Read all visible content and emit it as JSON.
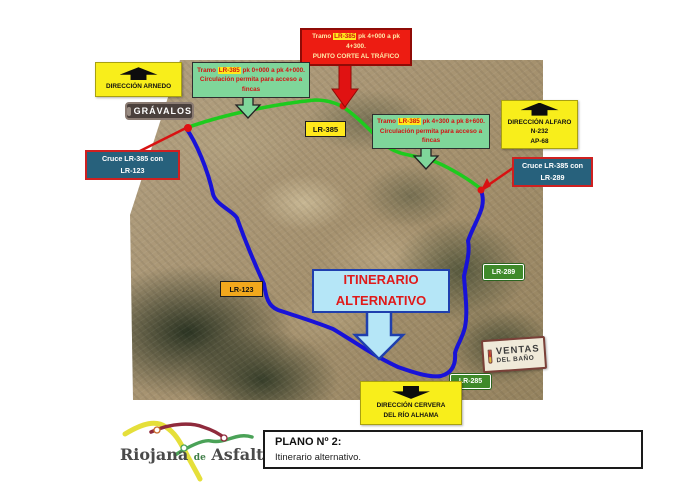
{
  "plan": {
    "cut_notice": {
      "pre": "Tramo ",
      "route": "LR-385",
      "post": " pk 4+000 a pk 4+300.",
      "line2": "PUNTO CORTE AL TRÁFICO"
    },
    "dir_arnedo": {
      "label": "DIRECCIÓN ARNEDO"
    },
    "tramo1": {
      "pre": "Tramo ",
      "route": "LR-385",
      "post": " pk 0+000 a pk 4+000. Circulación permita para acceso a fincas"
    },
    "tramo2": {
      "pre": "Tramo ",
      "route": "LR-385",
      "post": " pk 4+300 a pk 8+600. Circulación permita para acceso a fincas"
    },
    "gravalos": "GRÁVALOS",
    "lr385": "LR-385",
    "dir_alfaro": {
      "line1": "DIRECCIÓN ALFARO",
      "line2": "N-232",
      "line3": "AP-68"
    },
    "cruce_289": {
      "line1": "Cruce LR-385 con",
      "line2": "LR-289"
    },
    "cruce_123": {
      "line1": "Cruce LR-385 con",
      "line2": "LR-123"
    },
    "lr289": "LR-289",
    "lr123": "LR-123",
    "itinerario": {
      "line1": "ITINERARIO",
      "line2": "ALTERNATIVO"
    },
    "ventas": {
      "line1": "VENTAS",
      "line2": "DEL BAÑO"
    },
    "lr285": "LR-285",
    "dir_cervera": {
      "line1": "DIRECCIÓN CERVERA",
      "line2": "DEL RÍO ALHAMA"
    }
  },
  "colors": {
    "route_open_green": "#1ecb1e",
    "route_alternative_blue": "#1812d8",
    "alert_red": "#ed1c12",
    "direction_sign_yellow": "#f8ee1b",
    "info_box_green": "#7fd69a",
    "cruce_box_blue": "#27617c",
    "itinerary_fill_blue": "#b5e6f7",
    "itinerary_text_red": "#e01a1a"
  },
  "footer": {
    "logo": {
      "word1": "Riojana",
      "word2": "de",
      "word3": "Asfaltos"
    },
    "title_block": {
      "title": "PLANO Nº 2:",
      "subtitle": "Itinerario alternativo."
    }
  }
}
